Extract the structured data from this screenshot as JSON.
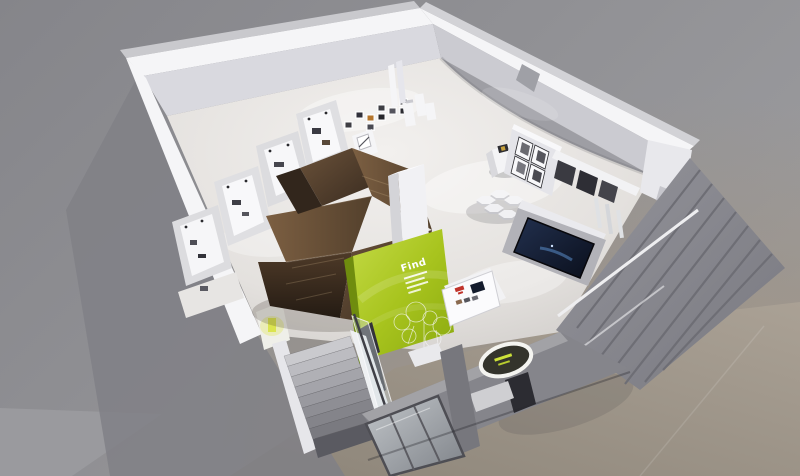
{
  "scene": {
    "type": "3d-interior-render",
    "subject": "bird's-eye cutaway render of a retail exhibition store"
  },
  "sign": {
    "text": "Find"
  },
  "colors": {
    "background_gray": "#8a8a8e",
    "background_warm": "#9d9489",
    "wall_white": "#f5f5f7",
    "wall_inner": "#d9d9df",
    "floor_light": "#efedeb",
    "floor_dim": "#d4d1ce",
    "facade_gray": "#85858b",
    "exterior_wall": "#7f7f85",
    "wood_dark": "#2f241b",
    "wood_mid": "#5a4430",
    "wood_light": "#7a5e40",
    "accent_green": "#a8c41e",
    "accent_green_dark": "#7d9a0f",
    "screen_navy": "#131b2c",
    "glass": "#a9adb2",
    "gold": "#c8a23c",
    "red_accent": "#c0332b",
    "stair_gray": "#b5b5ba",
    "sidewalk_warm": "#9a9186"
  }
}
